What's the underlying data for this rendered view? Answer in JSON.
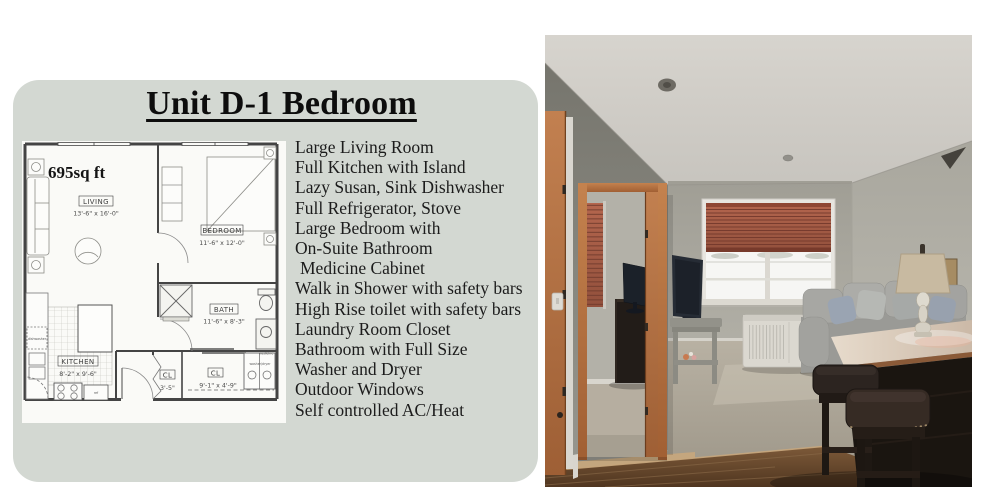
{
  "card": {
    "background_color": "#d3d8d2",
    "title": "Unit D-1 Bedroom",
    "features": [
      "Large Living Room",
      "Full Kitchen with Island",
      "Lazy Susan, Sink Dishwasher",
      "Full Refrigerator, Stove",
      "Large Bedroom with",
      "On-Suite Bathroom",
      "Medicine Cabinet",
      "Walk in Shower with safety bars",
      "High Rise toilet with safety bars",
      "Laundry Room Closet",
      "Bathroom with Full Size",
      "Washer and Dryer",
      "Outdoor Windows",
      "Self controlled AC/Heat"
    ]
  },
  "floorplan": {
    "area_label": "695sq ft",
    "rooms": [
      {
        "name": "LIVING",
        "dims": "13'-6\" x 16'-0\""
      },
      {
        "name": "BEDROOM",
        "dims": "11'-6\" x 12'-0\""
      },
      {
        "name": "BATH",
        "dims": "11'-6\" x 8'-3\""
      },
      {
        "name": "KITCHEN",
        "dims": "8'-2\" x 9'-6\""
      },
      {
        "name": "CL",
        "dims": "3'-5\""
      },
      {
        "name": "CL",
        "dims": "9'-1\" x 4'-9\""
      }
    ],
    "appliance_labels": {
      "dishwasher": "dishwasher",
      "refrigerator": "ref",
      "washer_dryer": "washer/dryer",
      "medicine": "medicine"
    }
  },
  "photo": {
    "colors": {
      "ceiling": "#ccc9c3",
      "left_wall": "#8b8a82",
      "back_wall": "#a8a69d",
      "right_wall": "#b5b3aa",
      "door_trim": "#b5713f",
      "blinds": "#a65d48",
      "couch": "#9c9c98",
      "island_top": "#d9cbbb",
      "island_base": "#1a1510",
      "carpet": "#ada699",
      "wood_floor": "#6b4c2e",
      "lamp_shade": "#c8baa1",
      "ac_unit": "#dbd8d0"
    }
  }
}
